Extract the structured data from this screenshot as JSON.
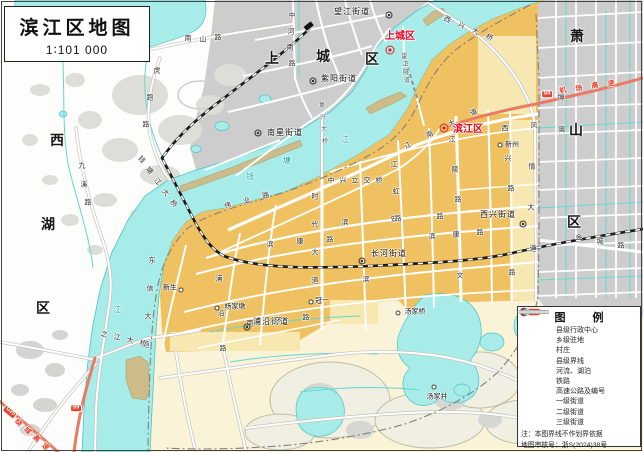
{
  "title": {
    "text": "滨江区地图",
    "scale": "1∶101 000"
  },
  "legend": {
    "title": "图 例",
    "items": [
      {
        "label": "县级行政中心",
        "symbol": "county-center"
      },
      {
        "label": "乡级驻地",
        "symbol": "township-seat"
      },
      {
        "label": "村庄",
        "symbol": "village"
      },
      {
        "label": "县级界线",
        "symbol": "county-boundary"
      },
      {
        "label": "河流、湖泊",
        "symbol": "river-lake"
      },
      {
        "label": "铁路",
        "symbol": "railway"
      },
      {
        "label": "高速公路及编号",
        "symbol": "expressway"
      },
      {
        "label": "一级街道",
        "symbol": "street-1"
      },
      {
        "label": "二级街道",
        "symbol": "street-2"
      },
      {
        "label": "三级街道",
        "symbol": "street-3"
      }
    ],
    "expressway_badge": "S4",
    "note": "注：本图界线不作划界依据",
    "approval": "地图审核号：浙S(2024)38号"
  },
  "colors": {
    "water": "#A8ECEA",
    "water_line": "#4CC5C2",
    "urban_gray": "#CDCDCD",
    "urban_orange": "#EFC160",
    "cream": "#FBF3D7",
    "expressway": "#E97B64",
    "red_label": "#E8001E",
    "railway": "#1A1A1A"
  },
  "markers": [
    {
      "k": "cc",
      "x": 390,
      "y": 50
    },
    {
      "k": "cc",
      "x": 444,
      "y": 128
    },
    {
      "k": "town",
      "x": 389,
      "y": 15
    },
    {
      "k": "town",
      "x": 313,
      "y": 81
    },
    {
      "k": "town",
      "x": 258,
      "y": 133
    },
    {
      "k": "town",
      "x": 523,
      "y": 224
    },
    {
      "k": "town",
      "x": 362,
      "y": 261
    },
    {
      "k": "town",
      "x": 247,
      "y": 327
    },
    {
      "k": "vill",
      "x": 217,
      "y": 308
    },
    {
      "k": "vill",
      "x": 181,
      "y": 290
    },
    {
      "k": "vill",
      "x": 398,
      "y": 313
    },
    {
      "k": "vill",
      "x": 434,
      "y": 387
    },
    {
      "k": "vill",
      "x": 311,
      "y": 302
    },
    {
      "k": "vill",
      "x": 500,
      "y": 145
    }
  ],
  "map_labels": [
    {
      "t": "西",
      "x": 57,
      "y": 140,
      "c": "dist"
    },
    {
      "t": "湖",
      "x": 48,
      "y": 224,
      "c": "dist"
    },
    {
      "t": "区",
      "x": 43,
      "y": 308,
      "c": "dist"
    },
    {
      "t": "上",
      "x": 272,
      "y": 58,
      "c": "dist"
    },
    {
      "t": "城",
      "x": 323,
      "y": 56,
      "c": "dist"
    },
    {
      "t": "区",
      "x": 372,
      "y": 59,
      "c": "dist"
    },
    {
      "t": "萧",
      "x": 577,
      "y": 36,
      "c": "dist"
    },
    {
      "t": "山",
      "x": 576,
      "y": 130,
      "c": "dist"
    },
    {
      "t": "区",
      "x": 574,
      "y": 222,
      "c": "dist"
    },
    {
      "t": "上城区",
      "x": 400,
      "y": 37,
      "c": "red"
    },
    {
      "t": "滨江区",
      "x": 468,
      "y": 130,
      "c": "red"
    },
    {
      "t": "望江街道",
      "x": 352,
      "y": 12,
      "c": "town"
    },
    {
      "t": "紫阳街道",
      "x": 339,
      "y": 79,
      "c": "town"
    },
    {
      "t": "南星街道",
      "x": 285,
      "y": 133,
      "c": "town"
    },
    {
      "t": "西兴街道",
      "x": 498,
      "y": 215,
      "c": "town"
    },
    {
      "t": "长河街道",
      "x": 389,
      "y": 254,
      "c": "town"
    },
    {
      "t": "浦沿街道",
      "x": 271,
      "y": 322,
      "c": "town"
    },
    {
      "t": "杨家墩",
      "x": 235,
      "y": 307,
      "c": "vill"
    },
    {
      "t": "新生",
      "x": 170,
      "y": 288,
      "c": "vill"
    },
    {
      "t": "汤家桥",
      "x": 415,
      "y": 312,
      "c": "vill"
    },
    {
      "t": "汤家井",
      "x": 437,
      "y": 397,
      "c": "vill"
    },
    {
      "t": "冠一",
      "x": 322,
      "y": 301,
      "c": "vill"
    },
    {
      "t": "新州",
      "x": 512,
      "y": 145,
      "c": "vill"
    },
    {
      "t": "南",
      "x": 188,
      "y": 39,
      "c": "road"
    },
    {
      "t": "山",
      "x": 203,
      "y": 40,
      "c": "road"
    },
    {
      "t": "路",
      "x": 218,
      "y": 38,
      "c": "road"
    },
    {
      "t": "中",
      "x": 292,
      "y": 16,
      "c": "road"
    },
    {
      "t": "河",
      "x": 291,
      "y": 32,
      "c": "road"
    },
    {
      "t": "南",
      "x": 290,
      "y": 48,
      "c": "road"
    },
    {
      "t": "路",
      "x": 292,
      "y": 64,
      "c": "road"
    },
    {
      "t": "虎",
      "x": 157,
      "y": 71,
      "c": "road"
    },
    {
      "t": "跑",
      "x": 150,
      "y": 98,
      "c": "road"
    },
    {
      "t": "路",
      "x": 146,
      "y": 125,
      "c": "road"
    },
    {
      "t": "九",
      "x": 82,
      "y": 166,
      "c": "road"
    },
    {
      "t": "溪",
      "x": 84,
      "y": 185,
      "c": "road"
    },
    {
      "t": "路",
      "x": 88,
      "y": 203,
      "c": "road"
    },
    {
      "t": "望",
      "x": 404,
      "y": 57,
      "c": "rdsm"
    },
    {
      "t": "江",
      "x": 405,
      "y": 65,
      "c": "rdsm"
    },
    {
      "t": "隧",
      "x": 406,
      "y": 73,
      "c": "rdsm"
    },
    {
      "t": "道",
      "x": 407,
      "y": 81,
      "c": "rdsm"
    },
    {
      "t": "中",
      "x": 331,
      "y": 181,
      "c": "road"
    },
    {
      "t": "兴",
      "x": 343,
      "y": 181,
      "c": "road"
    },
    {
      "t": "立",
      "x": 355,
      "y": 181,
      "c": "road"
    },
    {
      "t": "交",
      "x": 367,
      "y": 181,
      "c": "road"
    },
    {
      "t": "桥",
      "x": 379,
      "y": 181,
      "c": "road"
    },
    {
      "t": "江",
      "x": 408,
      "y": 146,
      "c": "road",
      "r": -24
    },
    {
      "t": "南",
      "x": 430,
      "y": 135,
      "c": "road",
      "r": -24
    },
    {
      "t": "大",
      "x": 452,
      "y": 124,
      "c": "road",
      "r": -24
    },
    {
      "t": "道",
      "x": 474,
      "y": 113,
      "c": "road",
      "r": -24
    },
    {
      "t": "滨",
      "x": 345,
      "y": 223,
      "c": "road"
    },
    {
      "t": "安",
      "x": 394,
      "y": 220,
      "c": "road"
    },
    {
      "t": "路",
      "x": 440,
      "y": 217,
      "c": "road"
    },
    {
      "t": "滨",
      "x": 270,
      "y": 245,
      "c": "road"
    },
    {
      "t": "康",
      "x": 300,
      "y": 242,
      "c": "road"
    },
    {
      "t": "路",
      "x": 330,
      "y": 240,
      "c": "road"
    },
    {
      "t": "滨",
      "x": 432,
      "y": 237,
      "c": "road"
    },
    {
      "t": "康",
      "x": 456,
      "y": 235,
      "c": "road"
    },
    {
      "t": "路",
      "x": 480,
      "y": 233,
      "c": "road"
    },
    {
      "t": "滨",
      "x": 366,
      "y": 280,
      "c": "road"
    },
    {
      "t": "文",
      "x": 460,
      "y": 276,
      "c": "road"
    },
    {
      "t": "路",
      "x": 512,
      "y": 273,
      "c": "road"
    },
    {
      "t": "南",
      "x": 250,
      "y": 324,
      "c": "road"
    },
    {
      "t": "环",
      "x": 278,
      "y": 321,
      "c": "road"
    },
    {
      "t": "路",
      "x": 306,
      "y": 318,
      "c": "road"
    },
    {
      "t": "东",
      "x": 152,
      "y": 261,
      "c": "road"
    },
    {
      "t": "信",
      "x": 150,
      "y": 289,
      "c": "road"
    },
    {
      "t": "大",
      "x": 148,
      "y": 317,
      "c": "road"
    },
    {
      "t": "道",
      "x": 146,
      "y": 345,
      "c": "road"
    },
    {
      "t": "浦",
      "x": 219,
      "y": 279,
      "c": "road"
    },
    {
      "t": "沿",
      "x": 221,
      "y": 314,
      "c": "road"
    },
    {
      "t": "路",
      "x": 223,
      "y": 349,
      "c": "road"
    },
    {
      "t": "伟",
      "x": 228,
      "y": 206,
      "c": "road",
      "r": -15
    },
    {
      "t": "业",
      "x": 247,
      "y": 201,
      "c": "road",
      "r": -15
    },
    {
      "t": "路",
      "x": 266,
      "y": 196,
      "c": "road",
      "r": -15
    },
    {
      "t": "时",
      "x": 315,
      "y": 197,
      "c": "road"
    },
    {
      "t": "代",
      "x": 315,
      "y": 225,
      "c": "road"
    },
    {
      "t": "大",
      "x": 315,
      "y": 253,
      "c": "road"
    },
    {
      "t": "道",
      "x": 315,
      "y": 281,
      "c": "road"
    },
    {
      "t": "江",
      "x": 394,
      "y": 165,
      "c": "road"
    },
    {
      "t": "虹",
      "x": 396,
      "y": 192,
      "c": "road"
    },
    {
      "t": "路",
      "x": 398,
      "y": 219,
      "c": "road"
    },
    {
      "t": "江",
      "x": 452,
      "y": 140,
      "c": "road"
    },
    {
      "t": "陵",
      "x": 455,
      "y": 170,
      "c": "road"
    },
    {
      "t": "路",
      "x": 458,
      "y": 200,
      "c": "road"
    },
    {
      "t": "西",
      "x": 505,
      "y": 129,
      "c": "road"
    },
    {
      "t": "兴",
      "x": 508,
      "y": 159,
      "c": "road"
    },
    {
      "t": "路",
      "x": 511,
      "y": 189,
      "c": "road"
    },
    {
      "t": "风",
      "x": 534,
      "y": 126,
      "c": "road"
    },
    {
      "t": "情",
      "x": 532,
      "y": 167,
      "c": "road"
    },
    {
      "t": "大",
      "x": 531,
      "y": 208,
      "c": "road"
    },
    {
      "t": "道",
      "x": 533,
      "y": 249,
      "c": "road"
    },
    {
      "t": "金",
      "x": 579,
      "y": 238,
      "c": "road"
    },
    {
      "t": "城",
      "x": 600,
      "y": 242,
      "c": "road"
    },
    {
      "t": "路",
      "x": 621,
      "y": 246,
      "c": "road"
    },
    {
      "t": "博",
      "x": 561,
      "y": 98,
      "c": "road"
    },
    {
      "t": "奥",
      "x": 562,
      "y": 130,
      "c": "road"
    },
    {
      "t": "西",
      "x": 447,
      "y": 20,
      "c": "road",
      "r": 28
    },
    {
      "t": "兴",
      "x": 461,
      "y": 26,
      "c": "road",
      "r": 28
    },
    {
      "t": "大",
      "x": 475,
      "y": 32,
      "c": "road",
      "r": 28
    },
    {
      "t": "桥",
      "x": 489,
      "y": 38,
      "c": "road",
      "r": 28
    },
    {
      "t": "复",
      "x": 322,
      "y": 106,
      "c": "rdsm"
    },
    {
      "t": "兴",
      "x": 323,
      "y": 118,
      "c": "rdsm"
    },
    {
      "t": "大",
      "x": 324,
      "y": 130,
      "c": "rdsm"
    },
    {
      "t": "桥",
      "x": 325,
      "y": 142,
      "c": "rdsm"
    },
    {
      "t": "钱",
      "x": 141,
      "y": 160,
      "c": "road",
      "r": 50
    },
    {
      "t": "塘",
      "x": 149,
      "y": 171,
      "c": "road",
      "r": 50
    },
    {
      "t": "江",
      "x": 157,
      "y": 182,
      "c": "road",
      "r": 50
    },
    {
      "t": "大",
      "x": 165,
      "y": 193,
      "c": "road",
      "r": 50
    },
    {
      "t": "桥",
      "x": 173,
      "y": 204,
      "c": "road",
      "r": 50
    },
    {
      "t": "之",
      "x": 104,
      "y": 335,
      "c": "road",
      "r": 12
    },
    {
      "t": "江",
      "x": 117,
      "y": 338,
      "c": "road",
      "r": 12
    },
    {
      "t": "大",
      "x": 130,
      "y": 341,
      "c": "road",
      "r": 12
    },
    {
      "t": "桥",
      "x": 143,
      "y": 344,
      "c": "road",
      "r": 12
    },
    {
      "t": "机",
      "x": 563,
      "y": 91,
      "c": "redrd",
      "r": -10
    },
    {
      "t": "场",
      "x": 579,
      "y": 89,
      "c": "redrd",
      "r": -10
    },
    {
      "t": "高",
      "x": 595,
      "y": 86,
      "c": "redrd",
      "r": -10
    },
    {
      "t": "速",
      "x": 611,
      "y": 84,
      "c": "redrd",
      "r": -10
    },
    {
      "t": "绕",
      "x": 18,
      "y": 423,
      "c": "redrd",
      "r": 45
    },
    {
      "t": "城",
      "x": 27,
      "y": 431,
      "c": "redrd",
      "r": 45
    },
    {
      "t": "高",
      "x": 36,
      "y": 439,
      "c": "redrd",
      "r": 45
    },
    {
      "t": "速",
      "x": 45,
      "y": 447,
      "c": "redrd",
      "r": 45
    },
    {
      "t": "钱",
      "x": 250,
      "y": 177,
      "c": "water"
    },
    {
      "t": "塘",
      "x": 287,
      "y": 161,
      "c": "water"
    },
    {
      "t": "江",
      "x": 345,
      "y": 140,
      "c": "water"
    },
    {
      "t": "江",
      "x": 117,
      "y": 310,
      "c": "water"
    },
    {
      "t": "S4",
      "x": 547,
      "y": 94,
      "c": "badge"
    },
    {
      "t": "S9",
      "x": 76,
      "y": 408,
      "c": "badge"
    },
    {
      "t": "G25",
      "x": 10,
      "y": 412,
      "c": "badge",
      "r": 40
    }
  ]
}
